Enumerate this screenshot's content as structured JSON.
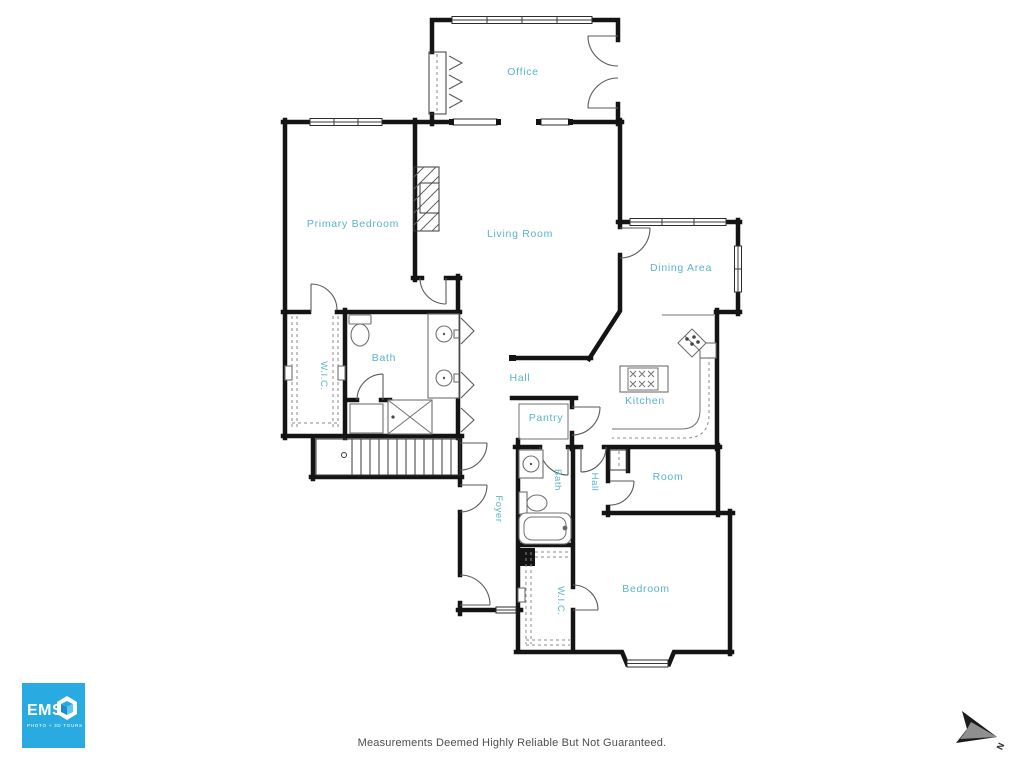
{
  "colors": {
    "wall": "#141414",
    "room_label": "#57b6c9",
    "logo_blue": "#29abe2",
    "disclaimer_text": "#4d4d4d"
  },
  "rooms": [
    {
      "id": "office",
      "label": "Office"
    },
    {
      "id": "primary-bedroom",
      "label": "Primary Bedroom"
    },
    {
      "id": "living-room",
      "label": "Living Room"
    },
    {
      "id": "dining-area",
      "label": "Dining Area"
    },
    {
      "id": "wic-primary",
      "label": "W.I.C."
    },
    {
      "id": "bath-primary",
      "label": "Bath"
    },
    {
      "id": "hall-upper",
      "label": "Hall"
    },
    {
      "id": "kitchen",
      "label": "Kitchen"
    },
    {
      "id": "pantry",
      "label": "Pantry"
    },
    {
      "id": "foyer",
      "label": "Foyer"
    },
    {
      "id": "bath-secondary",
      "label": "Bath"
    },
    {
      "id": "hall-lower",
      "label": "Hall"
    },
    {
      "id": "room",
      "label": "Room"
    },
    {
      "id": "bedroom",
      "label": "Bedroom"
    },
    {
      "id": "wic-secondary",
      "label": "W.I.C."
    }
  ],
  "footer": {
    "disclaimer": "Measurements Deemed Highly Reliable But Not Guaranteed."
  },
  "logo": {
    "name": "EMS",
    "tagline": "PHOTO + 3D TOURS"
  },
  "compass": {
    "label": "N"
  }
}
